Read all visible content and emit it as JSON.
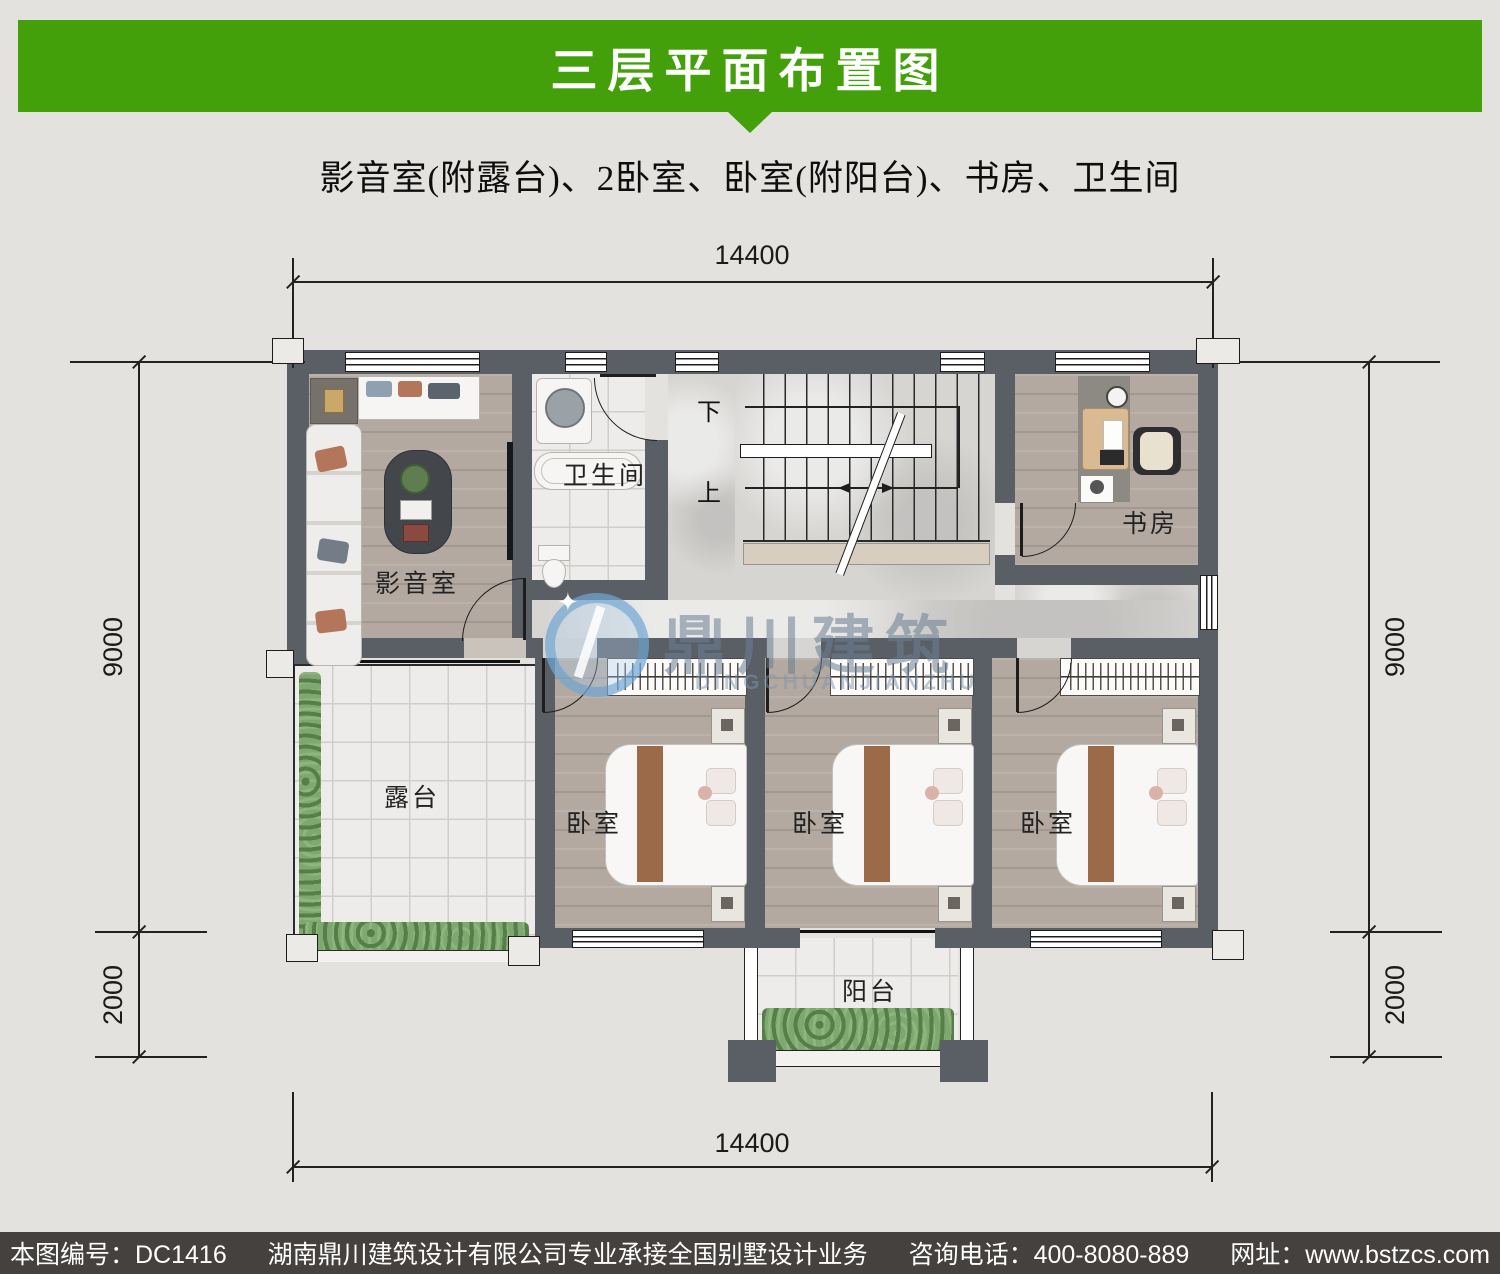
{
  "header": {
    "title": "三层平面布置图"
  },
  "subtitle": "影音室(附露台)、2卧室、卧室(附阳台)、书房、卫生间",
  "plan": {
    "rooms": {
      "media": "影音室",
      "bath": "卫生间",
      "study": "书房",
      "terrace": "露台",
      "bed1": "卧室",
      "bed2": "卧室",
      "bed3": "卧室",
      "balcony": "阳台"
    },
    "stairs": {
      "down": "下",
      "up": "上"
    },
    "dims": {
      "top": "14400",
      "bottom": "14400",
      "left_main": "9000",
      "left_lower": "2000",
      "right_main": "9000",
      "right_lower": "2000"
    },
    "watermark": {
      "cn": "鼎川建筑",
      "en": "DINGCHUANJIANZHU"
    }
  },
  "footer": {
    "no": "本图编号：DC1416",
    "company": "湖南鼎川建筑设计有限公司专业承接全国别墅设计业务",
    "phone": "咨询电话：400-8080-889",
    "site": "网址：www.bstzcs.com"
  },
  "colors": {
    "accent_green": "#43a00a",
    "wall_gray": "#5a5f66",
    "footer_bg": "#45413e",
    "background": "#e3e2de"
  }
}
